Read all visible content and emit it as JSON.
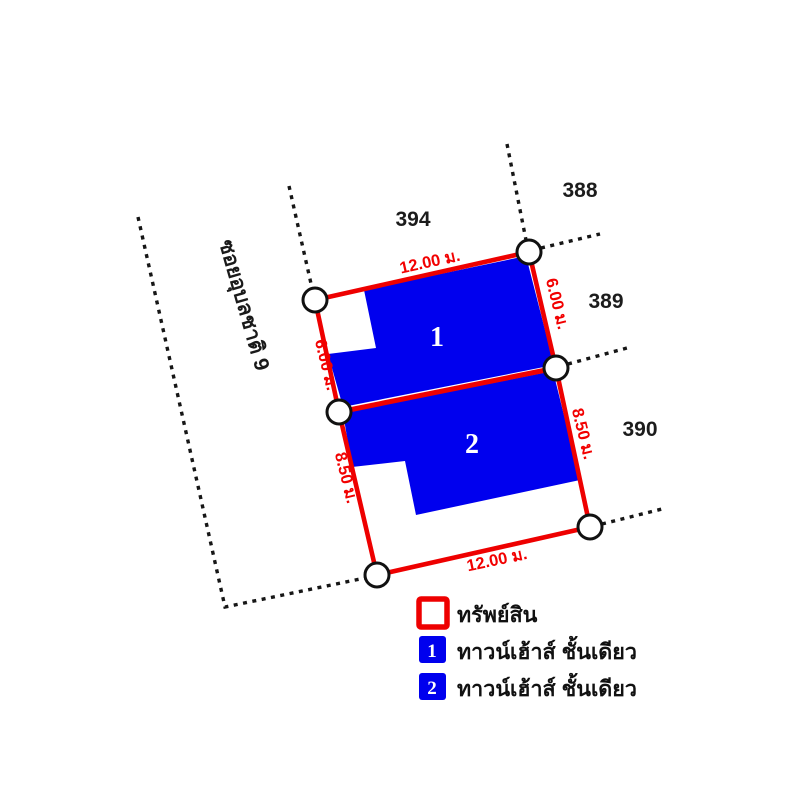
{
  "diagram": {
    "road_label": "ซอยอุบลชาติ 9",
    "parcels": [
      {
        "id": "394"
      },
      {
        "id": "388"
      },
      {
        "id": "389"
      },
      {
        "id": "390"
      }
    ],
    "dimensions": {
      "top": "12.00 ม.",
      "right_upper": "6.00 ม.",
      "right_lower": "8.50 ม.",
      "left_upper": "6.00 ม.",
      "left_lower": "8.50 ม.",
      "bottom": "12.00 ม."
    },
    "buildings": [
      {
        "number": "1"
      },
      {
        "number": "2"
      }
    ]
  },
  "legend": {
    "property_label": "ทรัพย์สิน",
    "items": [
      {
        "number": "1",
        "label": "ทาวน์เฮ้าส์ ชั้นเดียว"
      },
      {
        "number": "2",
        "label": "ทาวน์เฮ้าส์ ชั้นเดียว"
      }
    ]
  },
  "colors": {
    "property_outline": "#ee0000",
    "building_fill": "#0000ee",
    "dimension_text": "#f20000"
  }
}
